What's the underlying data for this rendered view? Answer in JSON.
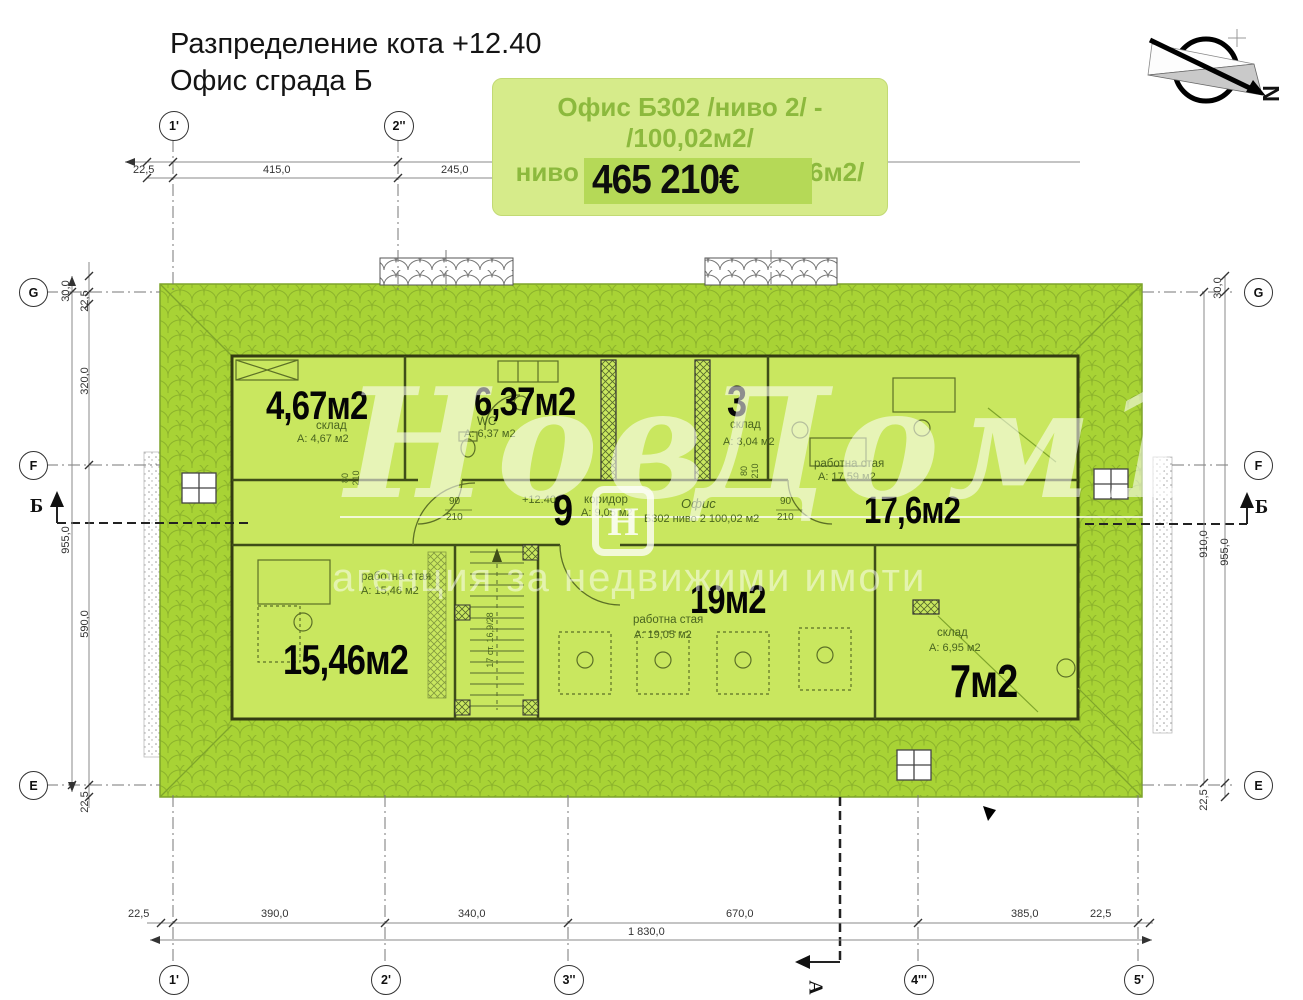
{
  "title": {
    "line1": "Разпределение  кота +12.40",
    "line2": "Офис сграда  Б"
  },
  "offer": {
    "line1": "Офис Б302 /ниво 2/ - /100,02м2/",
    "line2": "ниво 1 + ниво 2 - /211,46м2/",
    "price": "465 210€"
  },
  "north": {
    "label": "N"
  },
  "watermark": {
    "brand_left": "Нов",
    "brand_right": "Дом1",
    "tagline": "агенция за недвижими имоти",
    "logo_letter": "Н"
  },
  "grid": {
    "top1": "1'",
    "top2": "2''",
    "bottom1": "1'",
    "bottom2": "2'",
    "bottom3": "3''",
    "bottom4": "4'''",
    "bottom5": "5'",
    "left_g": "G",
    "left_f": "F",
    "left_e": "E",
    "right_g": "G",
    "right_f": "F",
    "right_e": "E"
  },
  "sections": {
    "b_left": "Б",
    "b_right": "Б",
    "a_bottom": "А"
  },
  "dims": {
    "top_225": "22,5",
    "top_415": "415,0",
    "top_245": "245,0",
    "bot_225a": "22,5",
    "bot_390": "390,0",
    "bot_340": "340,0",
    "bot_670": "670,0",
    "bot_385": "385,0",
    "bot_225b": "22,5",
    "bot_total": "1 830,0",
    "left_30": "30,0",
    "left_225a": "22,5",
    "left_320": "320,0",
    "left_955": "955,0",
    "left_590": "590,0",
    "left_225b": "22,5",
    "right_30": "30,0",
    "right_910": "910,0",
    "right_955": "955,0",
    "right_225": "22,5"
  },
  "rooms": {
    "storage1": {
      "big": "4,67м2",
      "name": "склад",
      "area": "A: 4,67 м2"
    },
    "wc": {
      "big": "6,37м2",
      "name": "WC",
      "area": "A: 6,37 м2"
    },
    "storage2": {
      "big": "3",
      "name": "склад",
      "area": "A: 3,04 м2"
    },
    "work1": {
      "big": "17,6м2",
      "name": "работна стая",
      "area": "A: 17,59 м2"
    },
    "corridor": {
      "big": "9",
      "name": "коридор",
      "area": "A: 9,05 м2"
    },
    "work2": {
      "big": "19м2",
      "name": "работна стая",
      "area": "A: 19,05 м2"
    },
    "work3": {
      "big": "15,46м2",
      "name": "работна стая",
      "area": "A: 15,46 м2"
    },
    "storage3": {
      "big": "7м2",
      "name": "склад",
      "area": "A: 6,95 м2"
    }
  },
  "annotations": {
    "level": "+12.40",
    "office_name": "Офис",
    "office_info": "Б302 ниво 2 100,02 м2",
    "door_width": "90",
    "door_height": "210",
    "wall_width": "80",
    "wall_height": "210",
    "stair_note": "17 ст. 16,9/28"
  },
  "colors": {
    "roof_green": "#a8d335",
    "floor_green": "#c9e75f",
    "offer_bg": "#d6eb8a",
    "offer_text": "#8cb93d",
    "price_band": "#b5d957",
    "label_black": "#050505",
    "wall_dark": "#3f4d18"
  }
}
